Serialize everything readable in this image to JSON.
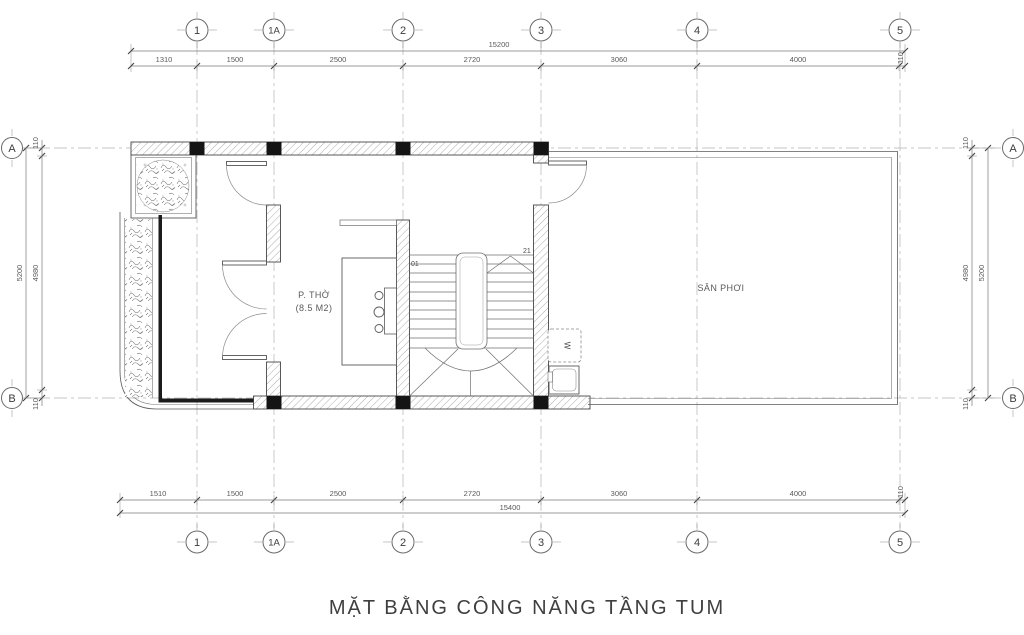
{
  "title": "MẶT BẰNG CÔNG NĂNG TẦNG TUM",
  "grid": {
    "cols": [
      "1",
      "1A",
      "2",
      "3",
      "4",
      "5"
    ],
    "rows": [
      "A",
      "B"
    ]
  },
  "dims": {
    "top": {
      "total": "15200",
      "segments": [
        "1310",
        "1500",
        "2500",
        "2720",
        "3060",
        "4000",
        "110"
      ]
    },
    "bottom": {
      "total": "15400",
      "segments": [
        "1510",
        "1500",
        "2500",
        "2720",
        "3060",
        "4000",
        "110"
      ]
    },
    "left": {
      "outer": "5200",
      "inner": "4980",
      "end_top": "110",
      "end_bottom": "110"
    },
    "right": {
      "outer": "5200",
      "inner": "4980",
      "end_top": "110",
      "end_bottom": "110"
    }
  },
  "rooms": {
    "worship_name": "P. THỜ",
    "worship_area": "(8.5 M2)",
    "drying_yard": "SÂN PHƠI"
  },
  "stair": {
    "start": "01",
    "end": "21"
  },
  "appliances": {
    "washer": "W"
  }
}
